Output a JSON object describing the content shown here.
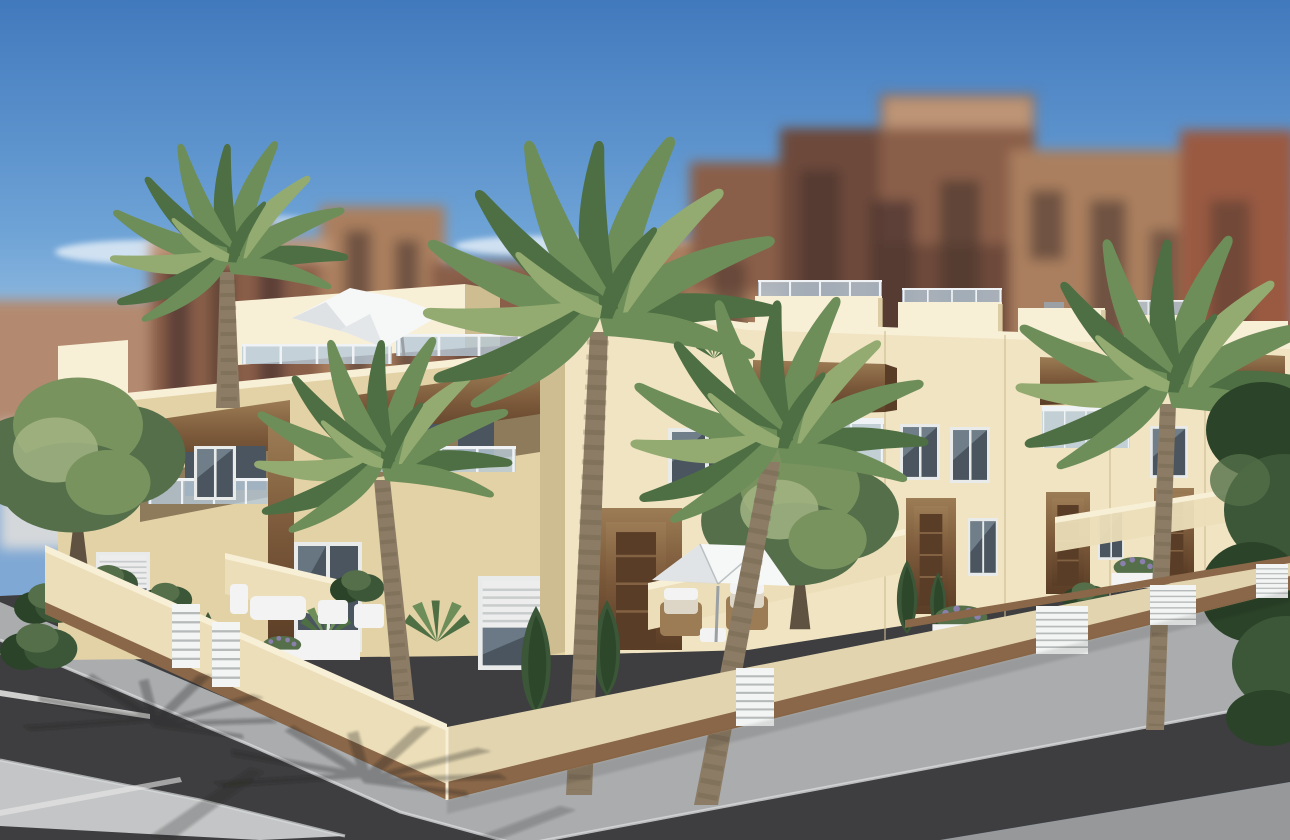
{
  "scene": {
    "type": "3d-architectural-render",
    "subject": "New-build two-storey cream townhouse complex on a street corner, with roof terraces, glass balustrades, wood-clad balconies, white parasols, palm trees and landscaped patios behind a low perimeter wall; blurred city apartment blocks and blue sky in the background; gray sidewalk and dark asphalt road with white parking lines in the foreground",
    "elements": [
      "blue sky with thin clouds",
      "blurred brown apartment blocks",
      "cream townhouse block (left wing)",
      "entrance tower",
      "townhouse row receding right",
      "roof terrace with white cantilever parasol and lounge sofa",
      "wood-clad balcony headers with glass balustrades",
      "windows with roller shutters",
      "patio parasol with two armchairs",
      "palm trees and garden shrubs",
      "perimeter wall with wood plinth and white slatted gates",
      "sidewalk, asphalt road, parking lines and light corner apron",
      "palm shadows on pavement"
    ]
  },
  "colors": {
    "sky_top": "#4179bd",
    "sky_mid": "#6ea3d6",
    "sky_horizon": "#b5d2ea",
    "cloud": "#eef4fa",
    "bg_brown": "#8a5f48",
    "bg_brown_dark": "#6d493a",
    "bg_tan": "#aa7f5f",
    "bg_pink": "#b38a70",
    "bg_red": "#9a5a43",
    "bg_win": "#4a3530",
    "bg_light": "#c9a182",
    "bg_wall": "#d5d8db",
    "facade_lit": "#f0e4c2",
    "facade_bright": "#f8efd7",
    "facade_side": "#e3d2a6",
    "facade_shade": "#cfbd92",
    "recess": "#8d7b5c",
    "wood": "#7c5a3b",
    "wood_dark": "#5a3d26",
    "wood_light": "#9c7c55",
    "rail_glass": "#b7c9d8",
    "rail_frame": "#f0f3f5",
    "win_glass": "#4a555f",
    "win_reflect": "#93a7b4",
    "win_frame": "#e9ebeb",
    "shutter": "#ededee",
    "shutter_line": "#c9cccc",
    "wall_cream": "#ebdeb8",
    "wall_plinth": "#8a6748",
    "gate": "#f3f5f5",
    "gate_line": "#b6bab9",
    "paver": "#9b9a94",
    "walk": "#aaacae",
    "apron": "#c3c5c6",
    "curb": "#d9dbdc",
    "asphalt": "#3e3e40",
    "pavement": "#96989a",
    "line": "#e9e9e7",
    "palm_a": "#6e8e59",
    "palm_b": "#4d6f43",
    "palm_c": "#93ab71",
    "trunk": "#8c7c65",
    "trunk_dark": "#5f5240",
    "tree_a": "#79935f",
    "tree_b": "#546f49",
    "tree_c": "#a2b483",
    "cypress_a": "#3b5738",
    "cypress_b": "#2b4328",
    "shadow": "#1f1f1d",
    "umbrella": "#f6f7f7",
    "umbrella_shade": "#d8dce0",
    "white": "#f2f3f2",
    "cushion": "#ddd5c5",
    "metal": "#9aa0a4",
    "lavender": "#8b7fae"
  }
}
